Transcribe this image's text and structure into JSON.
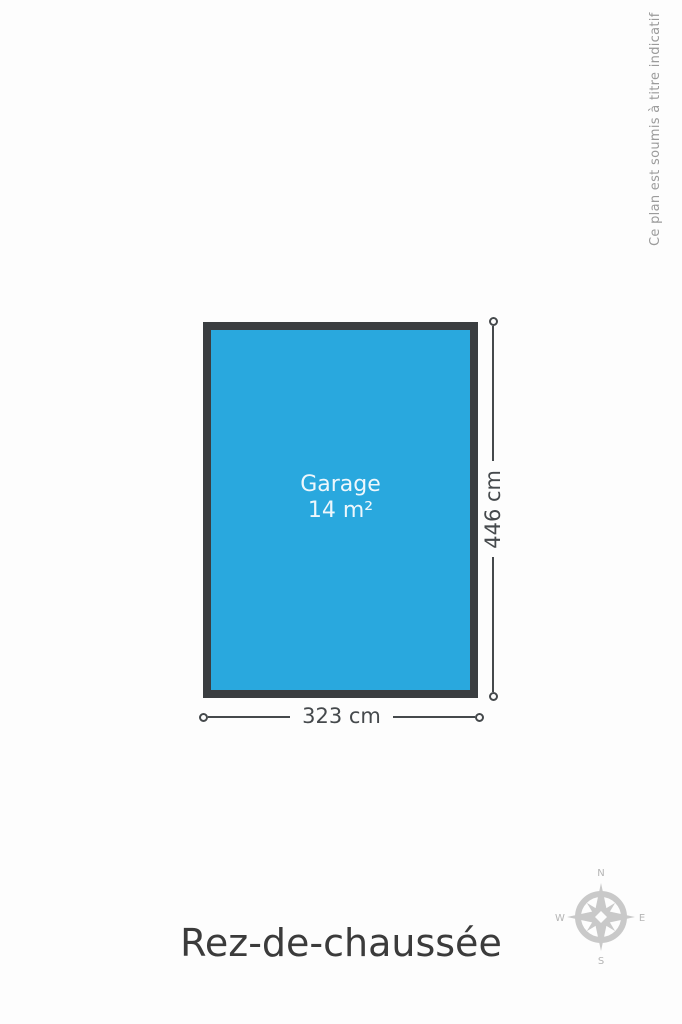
{
  "page": {
    "background_color": "#fdfdfd",
    "disclaimer_text": "Ce plan est soumis à titre indicatif",
    "floor_title": "Rez-de-chaussée"
  },
  "plan": {
    "room": {
      "label": "Garage",
      "area_label": "14 m²"
    },
    "dimensions": {
      "height": "446 cm",
      "width": "323 cm"
    }
  },
  "compass": {
    "north_label": "N",
    "south_label": "S",
    "east_label": "E",
    "west_label": "W"
  },
  "colors": {
    "page_bg": "#fdfdfd",
    "room_fill": "#29a8de",
    "room_border": "#3a3d40",
    "room_label_text": "#eef7fc",
    "dimension": "#45494c",
    "title_text": "#3b3b3b",
    "disclaimer_text": "#9b9b9b",
    "compass": "#c9c9c9",
    "compass_label": "#b5b5b5"
  }
}
